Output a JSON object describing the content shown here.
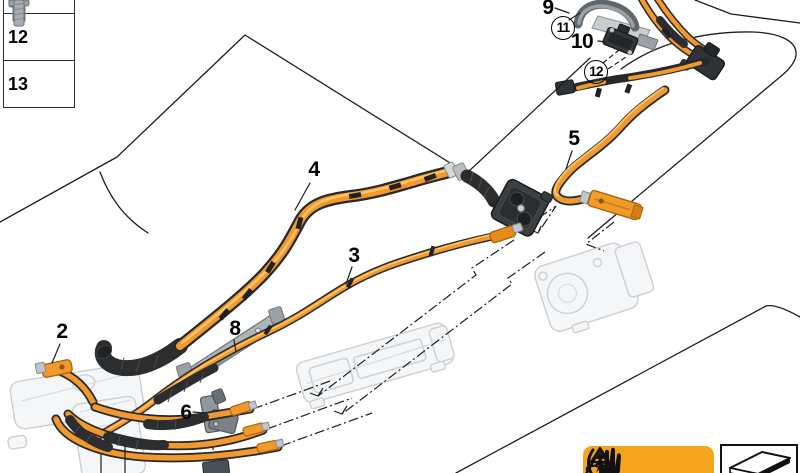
{
  "diagram": {
    "callouts": {
      "c2": {
        "label": "2"
      },
      "c3": {
        "label": "3"
      },
      "c4": {
        "label": "4"
      },
      "c5": {
        "label": "5"
      },
      "c6": {
        "label": "6"
      },
      "c8": {
        "label": "8"
      },
      "c9": {
        "label": "9"
      },
      "c10": {
        "label": "10"
      },
      "c11": {
        "label": "11"
      },
      "c12": {
        "label": "12"
      }
    },
    "parts_table": {
      "rows": [
        {
          "number": "12",
          "icon": "hex-flange-bolt-icon"
        },
        {
          "number": "13",
          "icon": "socket-head-screw-icon"
        }
      ],
      "partial_top_row_icon": "screw-shank-icon"
    },
    "warning_label": {
      "background_color": "#F5A41D",
      "icons": [
        "high-voltage-warning-icon",
        "read-manual-warning-icon",
        "protective-gloves-icon"
      ]
    },
    "sticker_box": {
      "icon": "adhesive-label-icon"
    },
    "colors": {
      "cable_orange": "#F2992E",
      "cable_highlight": "#FFC566",
      "cable_black": "#2B2D2F",
      "ghost_gray": "#CBCFD3",
      "part_gray": "#8F969C",
      "line_black": "#1C1C1C"
    }
  }
}
